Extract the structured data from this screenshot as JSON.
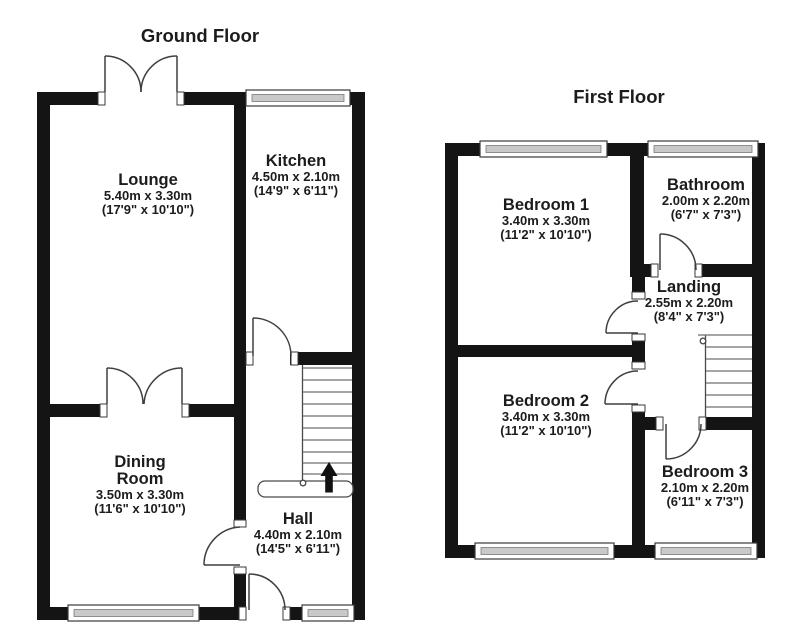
{
  "ground_floor": {
    "title": "Ground Floor",
    "rooms": {
      "lounge": {
        "name": "Lounge",
        "metric": "5.40m x 3.30m",
        "imperial": "(17'9\" x 10'10\")"
      },
      "kitchen": {
        "name": "Kitchen",
        "metric": "4.50m x 2.10m",
        "imperial": "(14'9\" x 6'11\")"
      },
      "dining_room": {
        "name": "Dining",
        "name2": "Room",
        "metric": "3.50m x 3.30m",
        "imperial": "(11'6\" x 10'10\")"
      },
      "hall": {
        "name": "Hall",
        "metric": "4.40m x 2.10m",
        "imperial": "(14'5\" x 6'11\")"
      }
    }
  },
  "first_floor": {
    "title": "First Floor",
    "rooms": {
      "bedroom1": {
        "name": "Bedroom 1",
        "metric": "3.40m x 3.30m",
        "imperial": "(11'2\" x 10'10\")"
      },
      "bathroom": {
        "name": "Bathroom",
        "metric": "2.00m x 2.20m",
        "imperial": "(6'7\" x 7'3\")"
      },
      "landing": {
        "name": "Landing",
        "metric": "2.55m x 2.20m",
        "imperial": "(8'4\" x 7'3\")"
      },
      "bedroom2": {
        "name": "Bedroom 2",
        "metric": "3.40m x 3.30m",
        "imperial": "(11'2\" x 10'10\")"
      },
      "bedroom3": {
        "name": "Bedroom 3",
        "metric": "2.10m x 2.20m",
        "imperial": "(6'11\" x 7'3\")"
      }
    }
  },
  "icons": {
    "stairs_direction": "up-arrow"
  },
  "colors": {
    "wall": "#141414",
    "window_fill": "#c9c9c9",
    "text": "#1c1c1c",
    "background": "#ffffff"
  }
}
